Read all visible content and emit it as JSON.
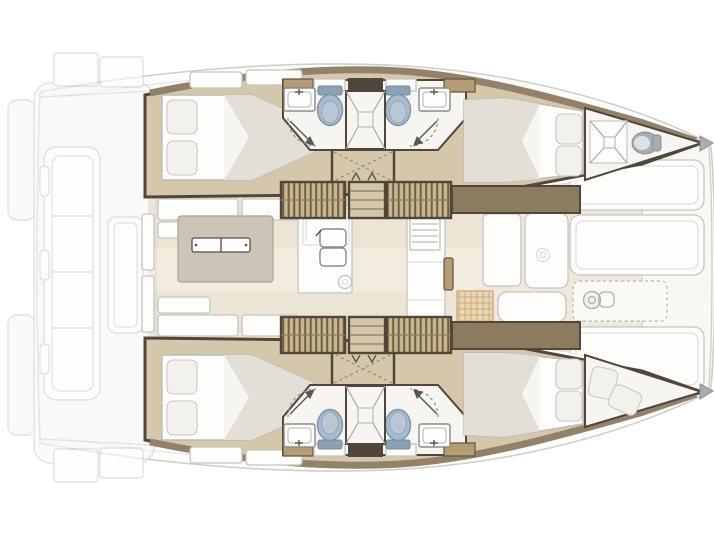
{
  "meta": {
    "view": "top-down catamaran interior layout, bow to the right"
  },
  "colors": {
    "canvas": "#ffffff",
    "deck": "#fdfdfc",
    "extFill": "#f7f7f4",
    "extLine": "#cfcfca",
    "hullFloor": "#d5c7aa",
    "wallDark": "#50463a",
    "wallWood": "#93816a",
    "woodBlock": "#b49c74",
    "cabinet": "#8d7b60",
    "stairLight": "#c9b68d",
    "stairDark": "#6e5f49",
    "bathFloor": "#f6f5f2",
    "white": "#fdfdfc",
    "furnLine": "#c6c5bf",
    "blanket": "#e3dfd7",
    "pillow": "#f3f1eb",
    "pillowLine": "#c9c8c1",
    "toilet": "#a9bccd",
    "toiletDark": "#7a94aa",
    "toiletInner": "#b9c7d4",
    "tank": "#8ba2b5",
    "saloonFloor": "#ece5d6",
    "saloonLight": "#f2ecdf",
    "fwdFloor": "#efe9dc",
    "island": "#ccc5b7",
    "rattan": "#ead7b2",
    "rattanLine": "#c9ab7c",
    "metal": "#a8adb0",
    "markDark": "#5b554c",
    "markSoft": "#8a857c"
  },
  "hulls": {
    "port": {
      "position": "top",
      "aft_cabin": "double berth with two pillows aft",
      "heads": [
        "sink",
        "toilet",
        "shower door swing"
      ],
      "heads_count": 2,
      "central_shower": "shower stall with tray and drain",
      "companionway": "slatted stairs down from saloon with landing",
      "forward_cabin": "double berth with two pillows forward",
      "bow": "crew compartment with cross-braced hatch and marine toilet"
    },
    "starboard": {
      "position": "bottom",
      "aft_cabin": "double berth with two pillows aft",
      "heads": [
        "sink",
        "toilet",
        "shower door swing"
      ],
      "heads_count": 2,
      "central_shower": "shower stall with tray and drain",
      "companionway": "slatted stairs down from saloon with landing",
      "forward_cabin": "double berth with two pillows forward",
      "bow": "forepeak berth with cushions"
    }
  },
  "saloon": {
    "features": [
      "sliding aft door",
      "settee seating",
      "galley island with twin handles",
      "fridge unit",
      "double galley sink",
      "kettle",
      "cooktop with grates",
      "counter locker",
      "forward cabinet doors with emblem",
      "rattan coffee table",
      "forward table",
      "forward cockpit floor"
    ]
  },
  "exterior": {
    "aft": [
      "transom swim steps",
      "aft platform",
      "cockpit bench with cushions",
      "cockpit table"
    ],
    "forward": [
      "foredeck sun pads",
      "hatch pad with dashed outline",
      "anchor windlass",
      "bow tip caps"
    ]
  }
}
